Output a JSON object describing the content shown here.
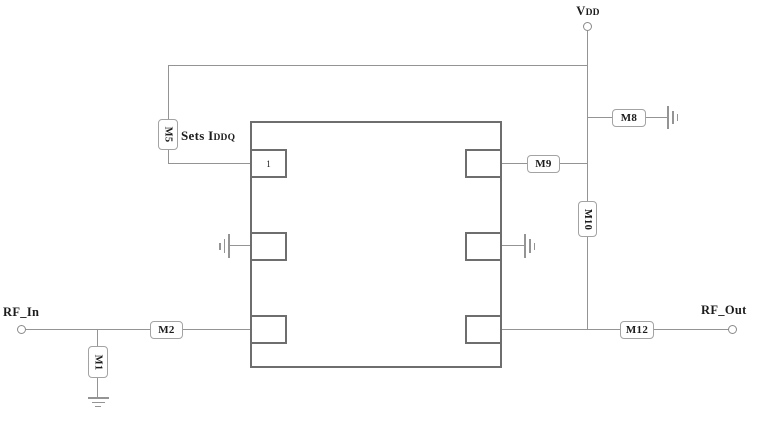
{
  "diagram": {
    "type": "circuit-schematic",
    "labels": {
      "vdd_main": "V",
      "vdd_sub": "DD",
      "rf_in": "RF_In",
      "rf_out": "RF_Out",
      "sets_main": "Sets I",
      "sets_sub": "DDQ"
    },
    "chip": {
      "pin1": "1"
    },
    "components": {
      "m1": "M1",
      "m2": "M2",
      "m5": "M5",
      "m8": "M8",
      "m9": "M9",
      "m10": "M10",
      "m12": "M12"
    },
    "colors": {
      "wire": "#949494",
      "chip_border": "#6e6e6e",
      "box_border": "#a3a3a3",
      "text": "#1c1c1c",
      "background": "#ffffff"
    }
  }
}
